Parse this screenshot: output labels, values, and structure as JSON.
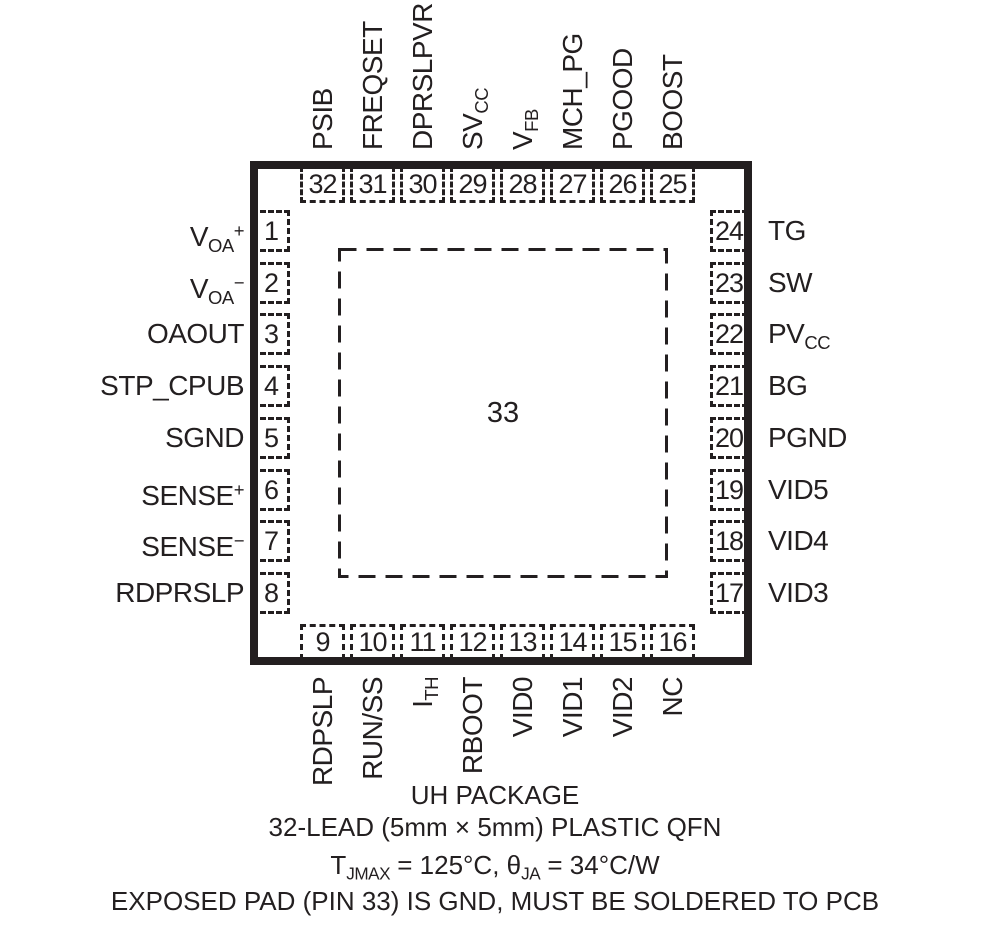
{
  "package": {
    "exposed_pad": {
      "number": "33"
    },
    "pins": {
      "top": [
        {
          "num": "32",
          "label": [
            {
              "t": "PSIB"
            }
          ]
        },
        {
          "num": "31",
          "label": [
            {
              "t": "FREQSET"
            }
          ]
        },
        {
          "num": "30",
          "label": [
            {
              "t": "DPRSLPVR"
            }
          ]
        },
        {
          "num": "29",
          "label": [
            {
              "t": "SV"
            },
            {
              "s": "CC"
            }
          ]
        },
        {
          "num": "28",
          "label": [
            {
              "t": "V"
            },
            {
              "s": "FB"
            }
          ]
        },
        {
          "num": "27",
          "label": [
            {
              "t": "MCH_PG"
            }
          ]
        },
        {
          "num": "26",
          "label": [
            {
              "t": "PGOOD"
            }
          ]
        },
        {
          "num": "25",
          "label": [
            {
              "t": "BOOST"
            }
          ]
        }
      ],
      "left": [
        {
          "num": "1",
          "label": [
            {
              "t": "V"
            },
            {
              "s": "OA"
            },
            {
              "p": "+"
            }
          ]
        },
        {
          "num": "2",
          "label": [
            {
              "t": "V"
            },
            {
              "s": "OA"
            },
            {
              "p": "−"
            }
          ]
        },
        {
          "num": "3",
          "label": [
            {
              "t": "OAOUT"
            }
          ]
        },
        {
          "num": "4",
          "label": [
            {
              "t": "STP_CPUB"
            }
          ]
        },
        {
          "num": "5",
          "label": [
            {
              "t": "SGND"
            }
          ]
        },
        {
          "num": "6",
          "label": [
            {
              "t": "SENSE"
            },
            {
              "p": "+"
            }
          ]
        },
        {
          "num": "7",
          "label": [
            {
              "t": "SENSE"
            },
            {
              "p": "−"
            }
          ]
        },
        {
          "num": "8",
          "label": [
            {
              "t": "RDPRSLP"
            }
          ]
        }
      ],
      "right": [
        {
          "num": "24",
          "label": [
            {
              "t": "TG"
            }
          ]
        },
        {
          "num": "23",
          "label": [
            {
              "t": "SW"
            }
          ]
        },
        {
          "num": "22",
          "label": [
            {
              "t": "PV"
            },
            {
              "s": "CC"
            }
          ]
        },
        {
          "num": "21",
          "label": [
            {
              "t": "BG"
            }
          ]
        },
        {
          "num": "20",
          "label": [
            {
              "t": "PGND"
            }
          ]
        },
        {
          "num": "19",
          "label": [
            {
              "t": "VID5"
            }
          ]
        },
        {
          "num": "18",
          "label": [
            {
              "t": "VID4"
            }
          ]
        },
        {
          "num": "17",
          "label": [
            {
              "t": "VID3"
            }
          ]
        }
      ],
      "bottom": [
        {
          "num": "9",
          "label": [
            {
              "t": "RDPSLP"
            }
          ]
        },
        {
          "num": "10",
          "label": [
            {
              "t": "RUN/SS"
            }
          ]
        },
        {
          "num": "11",
          "label": [
            {
              "t": "I"
            },
            {
              "s": "TH"
            }
          ]
        },
        {
          "num": "12",
          "label": [
            {
              "t": "RBOOT"
            }
          ]
        },
        {
          "num": "13",
          "label": [
            {
              "t": "VID0"
            }
          ]
        },
        {
          "num": "14",
          "label": [
            {
              "t": "VID1"
            }
          ]
        },
        {
          "num": "15",
          "label": [
            {
              "t": "VID2"
            }
          ]
        },
        {
          "num": "16",
          "label": [
            {
              "t": "NC"
            }
          ]
        }
      ]
    }
  },
  "caption": {
    "lines": [
      [
        {
          "t": "UH PACKAGE"
        }
      ],
      [
        {
          "t": "32-LEAD (5mm × 5mm) PLASTIC QFN"
        }
      ],
      [
        {
          "t": "T"
        },
        {
          "s": "JMAX"
        },
        {
          "t": " = 125°C, θ"
        },
        {
          "s": "JA"
        },
        {
          "t": " = 34°C/W"
        }
      ],
      [
        {
          "t": "EXPOSED PAD (PIN 33) IS GND, MUST BE SOLDERED TO PCB"
        }
      ]
    ]
  },
  "colors": {
    "ink": "#231f20",
    "background": "#ffffff"
  }
}
